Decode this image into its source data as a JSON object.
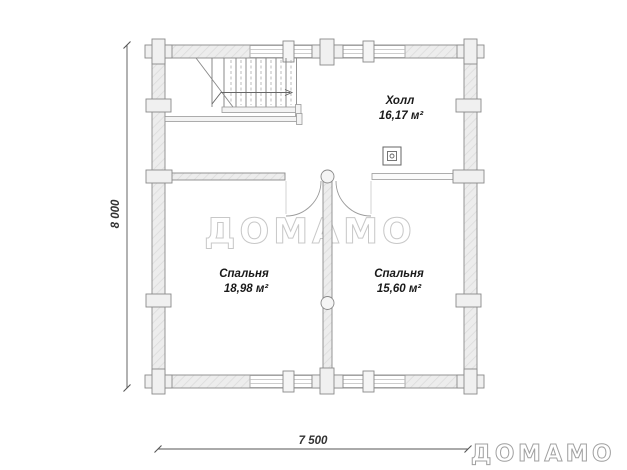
{
  "floor_plan": {
    "rooms": [
      {
        "name": "Холл",
        "area": "16,17 м²"
      },
      {
        "name": "Спальня",
        "area": "18,98 м²"
      },
      {
        "name": "Спальня",
        "area": "15,60 м²"
      }
    ],
    "dimensions": {
      "vertical": "8 000",
      "horizontal": "7 500"
    },
    "watermark": {
      "center": "ДОМАМО",
      "corner": "ДОМАМО"
    },
    "symbols": {
      "flue": "flue-marker-icon",
      "stairs": "staircase-symbol",
      "door": "door-swing-arc",
      "joint": "log-joint-marker",
      "window": "window-symbol"
    },
    "colors": {
      "wall_fill": "#ededed",
      "wall_hatch": "#dcdcdc",
      "wall_stroke": "#8a8a8a",
      "dimension": "#555555",
      "label": "#1a1a1a",
      "watermark_center": "#c8c8c8",
      "watermark_corner": "#a0a0a0"
    }
  }
}
